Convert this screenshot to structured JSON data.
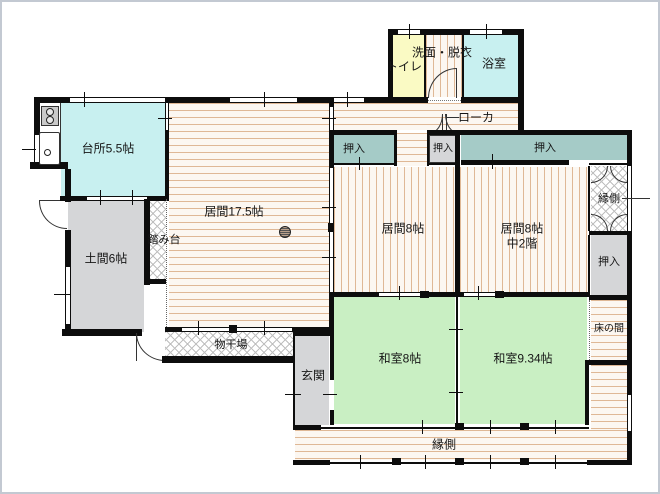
{
  "plan_title": "Japanese house floor plan",
  "colors": {
    "tatami_green": "#c9efc3",
    "flooring_cyan": "#c8f0f0",
    "closet_teal": "#a5cbc7",
    "earth_gray": "#d5d6d8",
    "toilet_yellow": "#fafac4",
    "stripe_tan": "#dfb896",
    "wall_black": "#0d0d0d"
  },
  "rooms": {
    "kitchen": {
      "label": "台所5.5帖"
    },
    "living_main": {
      "label": "居間17.5帖"
    },
    "corridor": {
      "label": "ローカ"
    },
    "toilet": {
      "label": "トイレ"
    },
    "washroom": {
      "label": "洗面・脱衣"
    },
    "bathroom": {
      "label": "浴室"
    },
    "closet_a": {
      "label": "押入"
    },
    "closet_b": {
      "label": "押入"
    },
    "closet_c": {
      "label": "押入"
    },
    "living8_west": {
      "label": "居間8帖"
    },
    "living8_east": {
      "label": "居間8帖",
      "sublabel": "中2階"
    },
    "engawa_east": {
      "label": "縁側"
    },
    "closet_east": {
      "label": "押入"
    },
    "tokonoma": {
      "label": "床の間"
    },
    "washitsu_8": {
      "label": "和室8帖"
    },
    "washitsu_934": {
      "label": "和室9.34帖"
    },
    "engawa_south": {
      "label": "縁側"
    },
    "genkan": {
      "label": "玄関"
    },
    "drying_area": {
      "label": "物干場"
    },
    "doma": {
      "label": "土間6帖"
    },
    "step": {
      "label": "踏み台"
    }
  }
}
